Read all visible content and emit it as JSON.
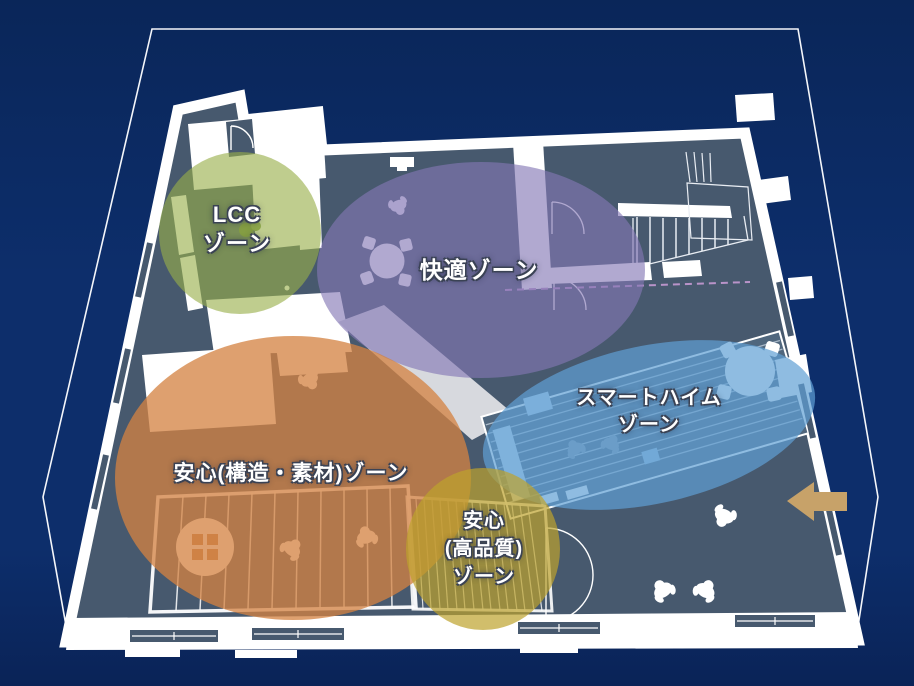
{
  "diagram": {
    "type": "floor-plan-zone-map",
    "background_color": "#0d2e6b",
    "floor_color": "#47596e",
    "wall_color": "#ffffff",
    "wireframe_color": "#ffffff",
    "zones": [
      {
        "id": "lcc",
        "lines": [
          "LCC",
          "ゾーン"
        ],
        "color": "#97ae48"
      },
      {
        "id": "kaiteki",
        "lines": [
          "快適ゾーン"
        ],
        "color": "#8478b6"
      },
      {
        "id": "smart-heim",
        "lines": [
          "スマートハイム",
          "ゾーン"
        ],
        "color": "#5fa0d6"
      },
      {
        "id": "anshin-kozo-sozai",
        "lines": [
          "安心(構造・素材)ゾーン"
        ],
        "color": "#e08a42"
      },
      {
        "id": "anshin-kohinshitsu",
        "lines": [
          "安心",
          "(高品質)",
          "ゾーン"
        ],
        "color": "#c3a636"
      }
    ],
    "icons": {
      "entrance_arrow": {
        "name": "entrance-arrow-icon",
        "direction": "left",
        "color": "#c7a269"
      },
      "person": "person-top-view-icon",
      "round_table": "round-table-icon",
      "stairs": "stairs-icon",
      "door": "door-swing-icon"
    }
  }
}
